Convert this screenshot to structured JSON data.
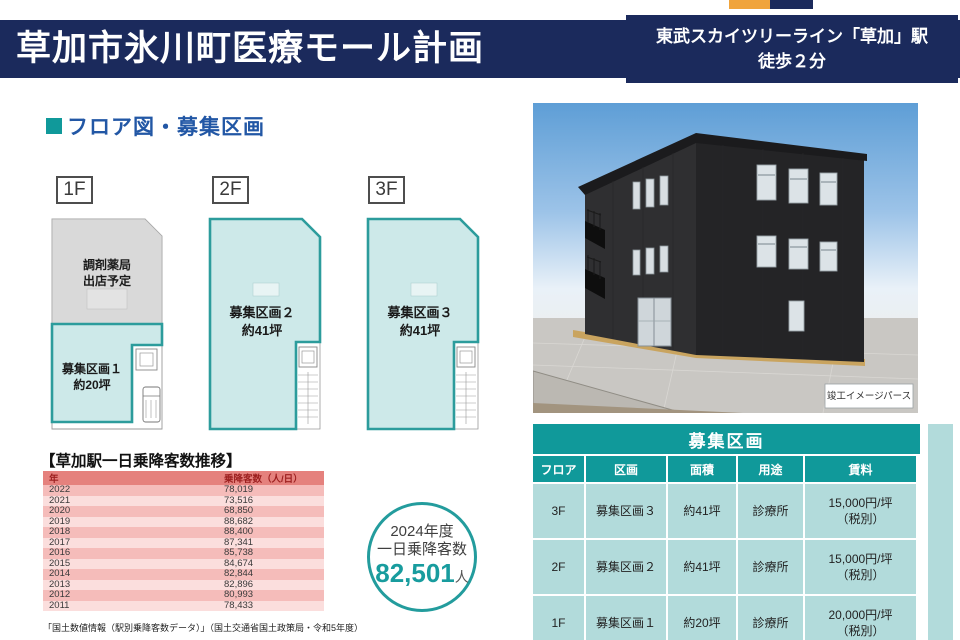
{
  "header": {
    "title": "草加市氷川町医療モール計画",
    "station_line1": "東武スカイツリーライン「草加」駅",
    "station_line2": "徒歩２分"
  },
  "section_heading": {
    "title": "フロア図・募集区画"
  },
  "floor_plans": {
    "floors": [
      {
        "tab": "1F",
        "pharmacy_line1": "調剤薬局",
        "pharmacy_line2": "出店予定",
        "zone_line1": "募集区画１",
        "zone_line2": "約20坪"
      },
      {
        "tab": "2F",
        "zone_line1": "募集区画２",
        "zone_line2": "約41坪"
      },
      {
        "tab": "3F",
        "zone_line1": "募集区画３",
        "zone_line2": "約41坪"
      }
    ]
  },
  "ridership": {
    "title": "【草加駅一日乗降客数推移】",
    "columns": [
      "年",
      "乗降客数（人/日）"
    ],
    "rows": [
      [
        "2022",
        "78,019"
      ],
      [
        "2021",
        "73,516"
      ],
      [
        "2020",
        "68,850"
      ],
      [
        "2019",
        "88,682"
      ],
      [
        "2018",
        "88,400"
      ],
      [
        "2017",
        "87,341"
      ],
      [
        "2016",
        "85,738"
      ],
      [
        "2015",
        "84,674"
      ],
      [
        "2014",
        "82,844"
      ],
      [
        "2013",
        "82,896"
      ],
      [
        "2012",
        "80,993"
      ],
      [
        "2011",
        "78,433"
      ]
    ],
    "footnote": "「国土数値情報（駅別乗降客数データ）」（国土交通省国土政策局・令和5年度）"
  },
  "highlight": {
    "line1": "2024年度",
    "line2": "一日乗降客数",
    "value": "82,501",
    "unit": "人"
  },
  "render_caption": "竣工イメージパース",
  "units": {
    "title": "募集区画",
    "headers": [
      "フロア",
      "区画",
      "面積",
      "用途",
      "賃料"
    ],
    "rows": [
      {
        "floor": "3F",
        "name": "募集区画３",
        "area": "約41坪",
        "use": "診療所",
        "rent": "15,000円/坪",
        "rent_note": "（税別）"
      },
      {
        "floor": "2F",
        "name": "募集区画２",
        "area": "約41坪",
        "use": "診療所",
        "rent": "15,000円/坪",
        "rent_note": "（税別）"
      },
      {
        "floor": "1F",
        "name": "募集区画１",
        "area": "約20坪",
        "use": "診療所",
        "rent": "20,000円/坪",
        "rent_note": "（税別）"
      }
    ]
  },
  "colors": {
    "navy": "#1b2a5c",
    "teal": "#10999a",
    "teal_light": "#b2dbdb",
    "accent_orange": "#f0a43c",
    "plan_fill": "#cde9e9",
    "plan_stroke": "#2c9c9c",
    "pink_header": "#e5817d",
    "pink_row_dark": "#f5bcba",
    "pink_row_light": "#fbdedd",
    "heading_blue": "#2257a5"
  }
}
